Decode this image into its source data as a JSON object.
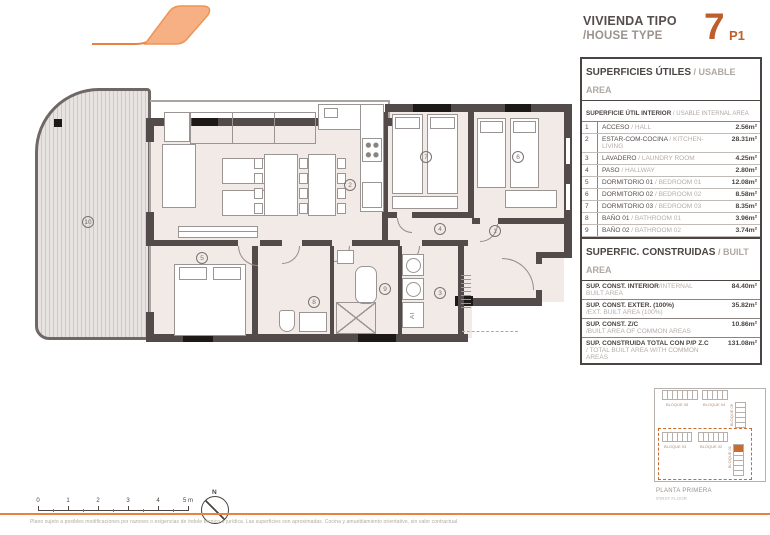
{
  "header": {
    "title_es": "VIVIENDA TIPO",
    "title_en": "/HOUSE TYPE",
    "unit_number": "7",
    "unit_floor": "P1"
  },
  "usable_table": {
    "title_es": "SUPERFICIES ÚTILES",
    "title_en": " / USABLE AREA",
    "subtitle_es": "SUPERFICIE ÚTIL INTERIOR",
    "subtitle_en": " / USABLE INTERNAL AREA",
    "rows": [
      {
        "num": "1",
        "es": "ACCESO",
        "en": " / HALL",
        "val": "2.56m²"
      },
      {
        "num": "2",
        "es": "ESTAR-COM-COCINA",
        "en": " / KITCHEN-LIVING",
        "val": "28.31m²"
      },
      {
        "num": "3",
        "es": "LAVADERO",
        "en": " / LAUNDRY ROOM",
        "val": "4.25m²"
      },
      {
        "num": "4",
        "es": "PASO",
        "en": " / HALLWAY",
        "val": "2.80m²"
      },
      {
        "num": "5",
        "es": "DORMITORIO 01",
        "en": " / BEDROOM 01",
        "val": "12.08m²"
      },
      {
        "num": "6",
        "es": "DORMITORIO 02",
        "en": " / BEDROOM 02",
        "val": "8.58m²"
      },
      {
        "num": "7",
        "es": "DORMITORIO 03",
        "en": " / BEDROOM 03",
        "val": "8.35m²"
      },
      {
        "num": "8",
        "es": "BAÑO 01",
        "en": " / BATHROOM 01",
        "val": "3.96m²"
      },
      {
        "num": "9",
        "es": "BAÑO 02",
        "en": " / BATHROOM 02",
        "val": "3.74m²"
      },
      {
        "num": "10",
        "es": "TERRAZA CUBIERTA (100%)",
        "en": "/ COVERED TERRACE (100%)",
        "val": "30.00m²"
      }
    ],
    "total_es": "SUPERFICIE ÚTIL TOTAL",
    "total_en": " / TOTAL USABLE AREA",
    "total_val": "104.63m²"
  },
  "built_table": {
    "title_es": "SUPERFIC. CONSTRUIDAS",
    "title_en": " / BUILT AREA",
    "rows": [
      {
        "es": "SUP. CONST. INTERIOR",
        "en": "/INTERNAL BUILT AREA",
        "val": "84.40m²"
      },
      {
        "es": "SUP. CONST. EXTER. (100%)",
        "en": "/EXT. BUILT AREA (100%)",
        "val": "35.82m²"
      },
      {
        "es": "SUP. CONST. Z/C",
        "en": "/BUILT AREA OF COMMON AREAS",
        "val": "10.86m²"
      },
      {
        "es": "SUP. CONSTRUIDA TOTAL CON P/P Z.C",
        "en": "/ TOTAL BUILT AREA WITH COMMON AREAS",
        "val": "131.08m²"
      }
    ]
  },
  "plan": {
    "rooms": {
      "r1": "1",
      "r2": "2",
      "r3": "3",
      "r4": "4",
      "r5": "5",
      "r6": "6",
      "r7": "7",
      "r8": "8",
      "r9": "9",
      "r10": "10"
    },
    "at_label": "AT"
  },
  "site_plan": {
    "top_left": "BLOQUE 05",
    "top_right": "BLOQUE 04",
    "right_top": "BLOQUE 06",
    "bottom_left": "BLOQUE 03",
    "bottom_mid": "BLOQUE 02",
    "right_bottom": "BLOQUE 01",
    "caption_es": "PLANTA PRIMERA",
    "caption_en": "/FIRST FLOOR"
  },
  "scale_bar": {
    "l0": "0",
    "l1": "1",
    "l2": "2",
    "l3": "3",
    "l4": "4",
    "l5": "5 m"
  },
  "north_label": "N",
  "footer": {
    "disclaimer": "Plano sujeto a posibles modificaciones por razones o exigencias de índole técnico o jurídica. Las superficies son aproximadas. Cocina y amueblamiento orientativo, sin valor contractual."
  },
  "colors": {
    "accent": "#C76B2E",
    "unit_number": "#BE5F2B",
    "wall": "#534B49",
    "floor": "#F2EAE7",
    "rule": "#E8833E"
  }
}
